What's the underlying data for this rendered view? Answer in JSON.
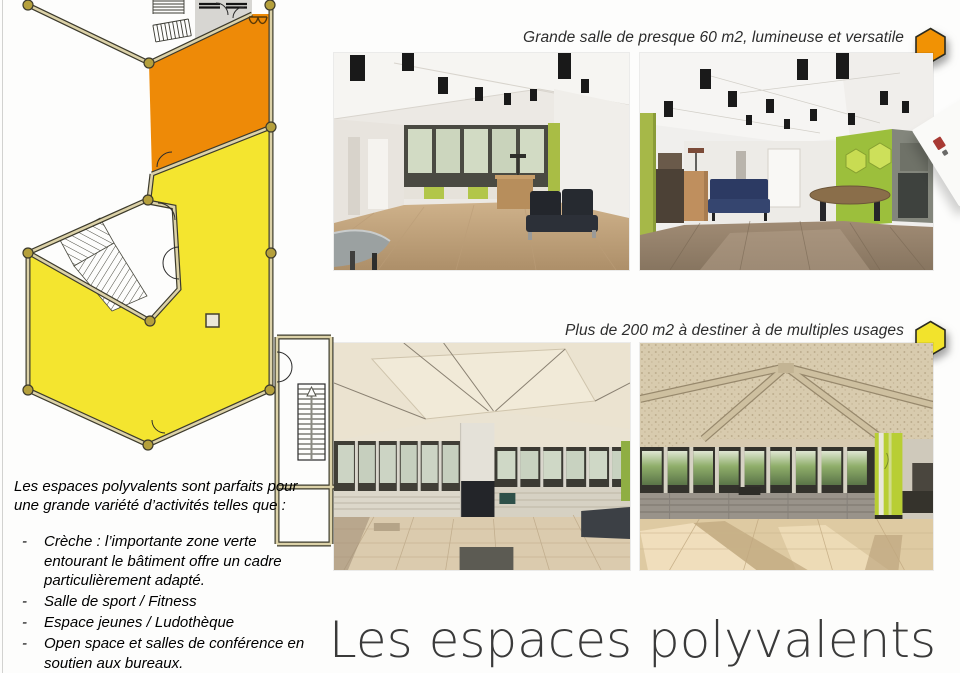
{
  "page": {
    "title": "Les espaces polyvalents",
    "background": "#fdfdfc",
    "title_color": "#3a3a3a"
  },
  "captions": {
    "top": {
      "text": "Grande salle de presque 60 m2, lumineuse et versatile",
      "badge_color": "#F19204"
    },
    "bottom": {
      "text": "Plus de 200 m2 à destiner à de multiples usages",
      "badge_color": "#F2E32C"
    }
  },
  "description": {
    "intro": "Les espaces polyvalents sont parfaits pour une grande variété d’activités telles que :",
    "items": [
      "Crèche : l’importante zone verte entourant le bâtiment offre un cadre particulièrement adapté.",
      "Salle de sport / Fitness",
      "Espace jeunes / Ludothèque",
      "Open space et salles de conférence en soutien aux bureaux."
    ]
  },
  "floor_plan": {
    "colors": {
      "room_orange": "#EE8A07",
      "room_yellow": "#F4E52F",
      "wall": "#DCD2A8",
      "wall_outline": "#3C3A2C",
      "node": "#B5A03C",
      "annex_gray": "#D7D6D2"
    }
  }
}
